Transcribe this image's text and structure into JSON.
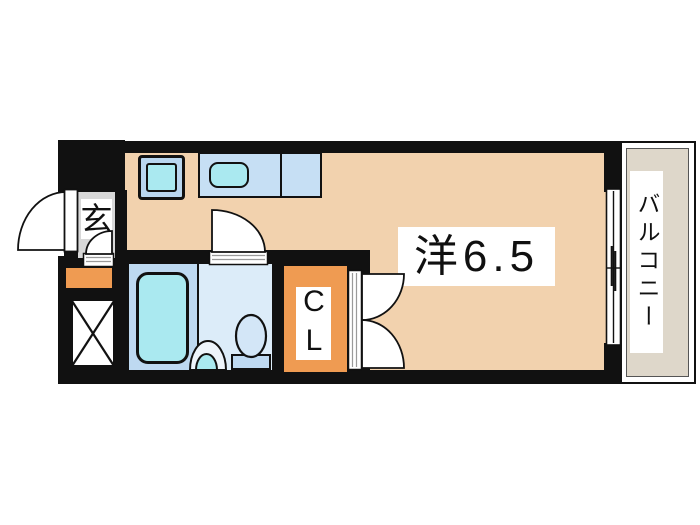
{
  "type": "japanese-apartment-floor-plan",
  "labels": {
    "entrance": "玄",
    "main_room": "洋6.5",
    "closet": "CL",
    "balcony": "バルコニー"
  },
  "fixtures": [
    "entrance-door",
    "genkan-step-door",
    "bathroom-door",
    "closet-double-doors",
    "bathtub",
    "washbasin",
    "toilet",
    "kitchen-stove-unit",
    "kitchen-counter",
    "kitchen-sink",
    "sliding-window",
    "pipe-space"
  ],
  "colors": {
    "wall": "#111111",
    "floor": "#f2d2ae",
    "orange": "#ef9b52",
    "genkan": "#d8d8d8",
    "counter": "#c6dff4",
    "cyan": "#aae9f0",
    "bath": "#bed9f1",
    "washroom": "#dcecf9",
    "unitblue": "#b9d6ef",
    "toiletblue": "#d3e6f7",
    "balcony": "#ded7ca"
  }
}
